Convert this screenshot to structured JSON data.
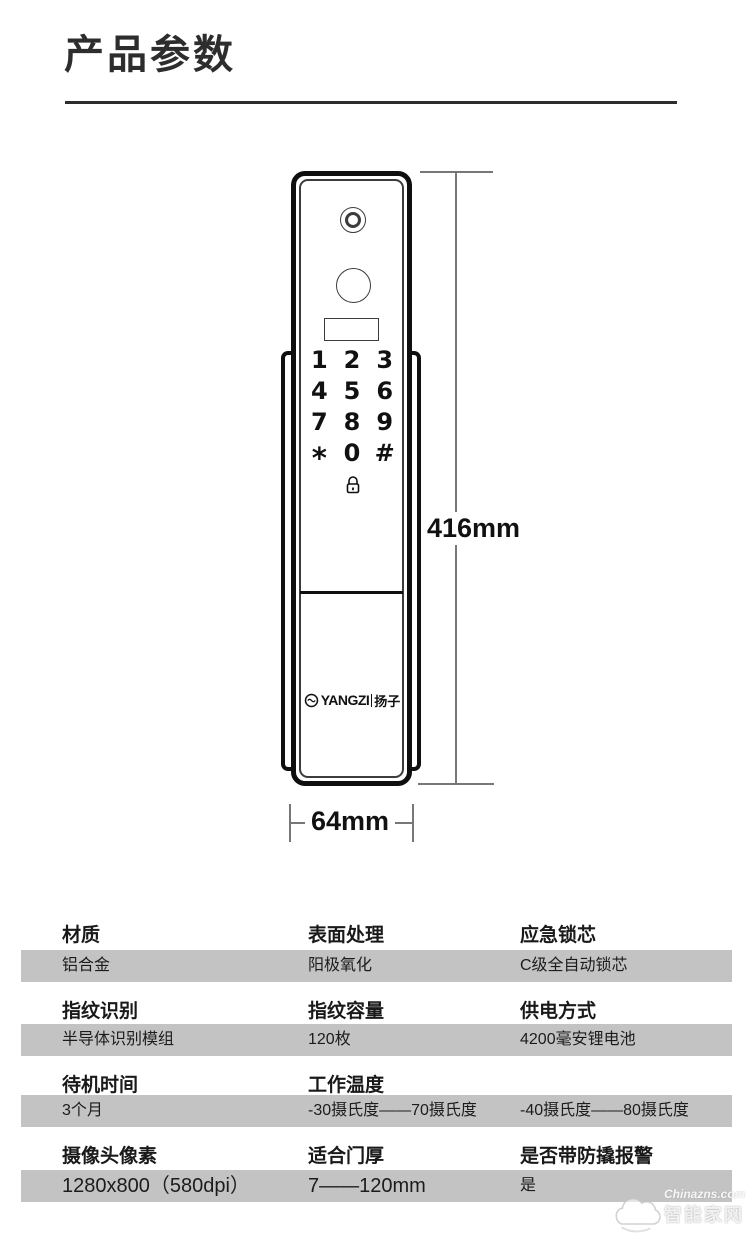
{
  "page": {
    "title": "产品参数"
  },
  "diagram": {
    "height_label": "416mm",
    "width_label": "64mm",
    "keypad": [
      "1",
      "2",
      "3",
      "4",
      "5",
      "6",
      "7",
      "8",
      "9",
      "*",
      "0",
      "#"
    ],
    "logo": {
      "brand": "YANGZI",
      "cn": "扬子"
    }
  },
  "table": {
    "rows": [
      {
        "headers": [
          "材质",
          "表面处理",
          "应急锁芯"
        ],
        "values": [
          "铝合金",
          "阳极氧化",
          "C级全自动锁芯"
        ]
      },
      {
        "headers": [
          "指纹识别",
          "指纹容量",
          "供电方式"
        ],
        "values": [
          "半导体识别模组",
          "120枚",
          "4200毫安锂电池"
        ]
      },
      {
        "headers": [
          "待机时间",
          "工作温度",
          ""
        ],
        "values": [
          "3个月",
          "-30摄氏度——70摄氏度",
          "-40摄氏度——80摄氏度"
        ]
      },
      {
        "headers": [
          "摄像头像素",
          "适合门厚",
          "是否带防撬报警"
        ],
        "values": [
          "1280x800（580dpi）",
          "7——120mm",
          "是"
        ]
      }
    ]
  },
  "watermark": {
    "site": "Chinazns.com",
    "name": "智能家网"
  },
  "colors": {
    "band": "#c3c3c3",
    "ink": "#2d2d2d",
    "dim_line": "#777777"
  }
}
